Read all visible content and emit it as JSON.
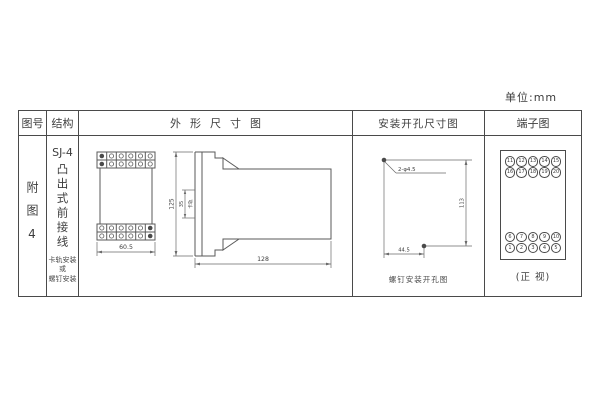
{
  "unit_label": "单位:mm",
  "headers": {
    "figure": "图号",
    "structure": "结构",
    "outline": "外形尺寸图",
    "mounting": "安装开孔尺寸图",
    "terminal": "端子图"
  },
  "figure_cell": {
    "label": "附图4"
  },
  "structure_cell": {
    "model": "SJ-4",
    "type_text": "凸出式前接线",
    "mount_lines": [
      "卡轨安装",
      "或",
      "螺钉安装"
    ]
  },
  "outline_cell": {
    "front_width": "60.5",
    "side_height": "125",
    "rail_dim": "35",
    "rail_label": "卡轨",
    "side_depth": "128"
  },
  "mounting_cell": {
    "holes_label": "2-φ4.5",
    "dim_vertical": "113",
    "dim_horizontal": "44.5",
    "caption": "螺钉安装开孔图"
  },
  "terminal_cell": {
    "top_rows": [
      [
        "11",
        "12",
        "13",
        "14",
        "15"
      ],
      [
        "16",
        "17",
        "18",
        "19",
        "20"
      ]
    ],
    "bottom_rows": [
      [
        "6",
        "7",
        "8",
        "9",
        "10"
      ],
      [
        "1",
        "2",
        "3",
        "4",
        "5"
      ]
    ],
    "caption": "(正 视)"
  }
}
